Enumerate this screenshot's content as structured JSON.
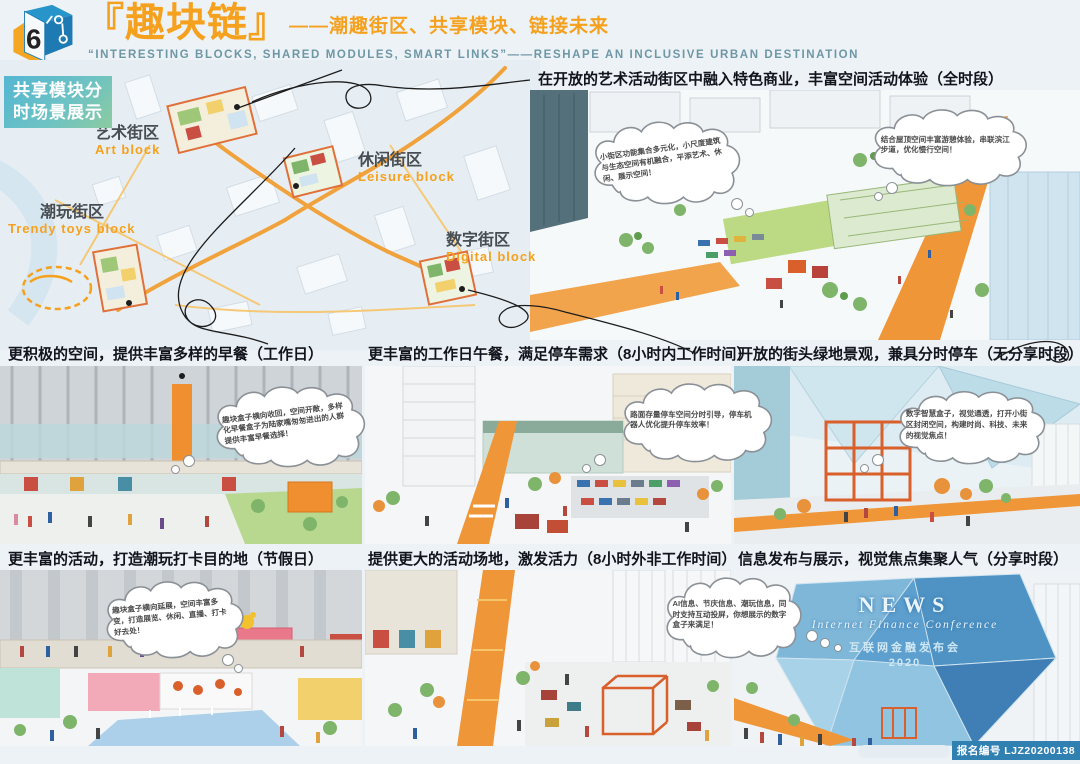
{
  "header": {
    "logo_number": "6",
    "title_cn": "『趣块链』",
    "title_sub": "——潮趣街区、共享模块、链接未来",
    "subtitle_en": "“INTERESTING BLOCKS, SHARED MODULES, SMART LINKS”——RESHAPE AN INCLUSIVE URBAN DESTINATION"
  },
  "badge": {
    "line1": "共享模块分",
    "line2": "时场景展示"
  },
  "map": {
    "blocks": [
      {
        "zh": "艺术街区",
        "en": "Art block"
      },
      {
        "zh": "休闲街区",
        "en": "Leisure block"
      },
      {
        "zh": "潮玩街区",
        "en": "Trendy toys block"
      },
      {
        "zh": "数字街区",
        "en": "Digital block"
      }
    ]
  },
  "hero": {
    "caption": "在开放的艺术活动街区中融入特色商业，丰富空间活动体验（全时段）",
    "bubble1": "小街区功能集合多元化，小尺度建筑与生态空间有机融合，平添艺术、休闲、展示空间！",
    "bubble2": "结合屋顶空间丰富游憩体验，串联滨江步道，优化慢行空间！"
  },
  "mid_left": {
    "caption": "更积极的空间，提供丰富多样的早餐（工作日）",
    "bubble": "趣块盒子横向收回，空间开敞，多样化早餐盒子为陆家嘴匆匆进出的人群提供丰富早餐选择！"
  },
  "mid_center": {
    "caption": "更丰富的工作日午餐，满足停车需求（8小时内工作时间）",
    "bubble": "路面存量停车空间分时引导，停车机器人优化提升停车效率！"
  },
  "mid_right": {
    "caption": "开放的街头绿地景观，兼具分时停车（无分享时段）",
    "bubble": "数字智慧盒子，视觉通透，打开小街区封闭空间，构建时尚、科技、未来的视觉焦点！"
  },
  "bottom_left": {
    "caption": "更丰富的活动，打造潮玩打卡目的地（节假日）",
    "bubble": "趣块盒子横向延展，空间丰富多变，打造展览、休闲、直播、打卡好去处！"
  },
  "bottom_center": {
    "caption": "提供更大的活动场地，激发活力（8小时外非工作时间）"
  },
  "bottom_right": {
    "caption": "信息发布与展示，视觉焦点集聚人气（分享时段）",
    "bubble": "AI信息、节庆信息、潮玩信息，同时支持互动投屏，你想展示的数字盒子来满足！",
    "news": {
      "l1": "NEWS",
      "l2": "Internet Finance Conference",
      "l3": "互联网金融发布会",
      "l4": "2020"
    }
  },
  "footer": {
    "registration": "报名编号 LJZ20200138"
  },
  "colors": {
    "accent_orange": "#F5A11E",
    "subtitle_teal": "#6E97A5",
    "badge_cyan": "#54B6D2",
    "footer_blue": "#3180B2"
  }
}
